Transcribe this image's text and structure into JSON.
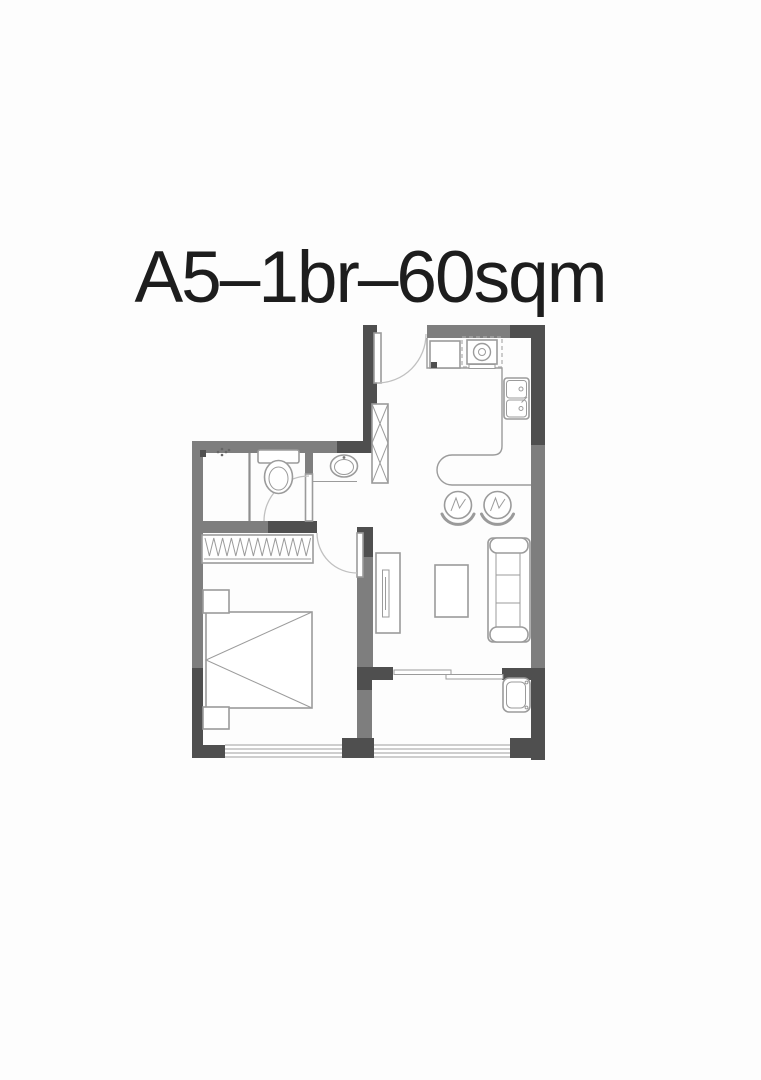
{
  "title": "A5–1br–60sqm",
  "colors": {
    "background": "#fdfdfd",
    "wall_dark": "#4f4f4f",
    "wall_gray": "#7e7e7e",
    "furniture_line": "#9b9b9b",
    "title_text": "#1d1d1d"
  },
  "plan": {
    "type": "apartment-floor-plan",
    "unit": "A5",
    "bedrooms": "1br",
    "area": "60sqm",
    "fixtures": [
      "entry-door",
      "duct-shaft",
      "fridge",
      "range-hood",
      "stove",
      "kitchen-counter",
      "breakfast-bar",
      "bar-stool",
      "bar-stool",
      "kitchen-sink",
      "vanity-sink",
      "toilet",
      "shower",
      "floor-drain",
      "bathroom-door",
      "wardrobe",
      "bedroom-door",
      "bed",
      "nightstand",
      "nightstand",
      "tv-stand",
      "coffee-table",
      "sofa",
      "sliding-door",
      "washing-machine",
      "bedroom-window",
      "balcony-window"
    ]
  }
}
